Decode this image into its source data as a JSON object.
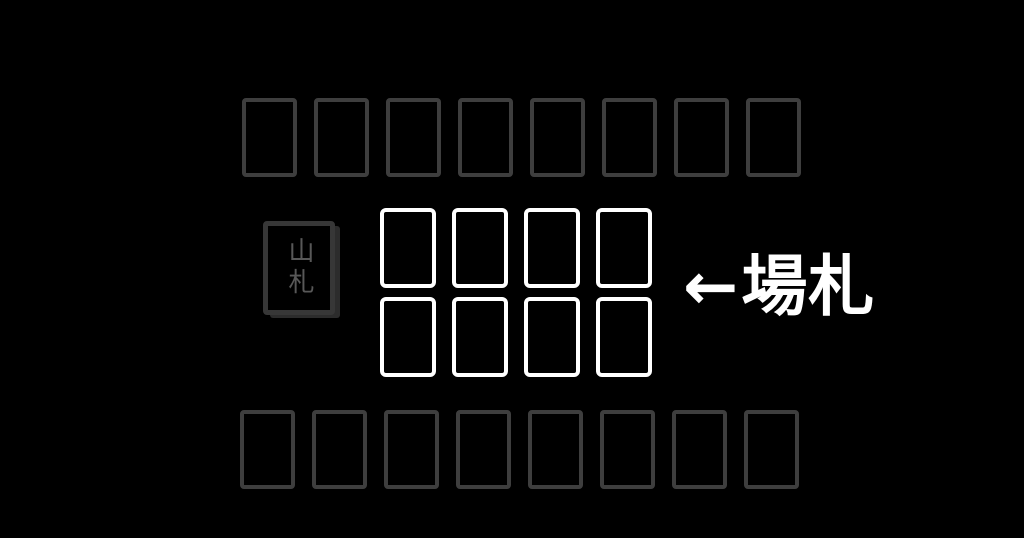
{
  "opponent_hand": {
    "card_count": 8
  },
  "deck": {
    "label": "山札"
  },
  "field": {
    "card_count": 8,
    "columns": 4,
    "rows": 2
  },
  "annotation": {
    "arrow": "←",
    "label": "場札"
  },
  "player_hand": {
    "card_count": 8
  },
  "colors": {
    "background": "#000000",
    "hand_card_border": "#3e3e3e",
    "deck_border": "#373737",
    "deck_stack_edge": "#2c2c2c",
    "deck_label_text": "#585858",
    "field_card_border": "#ffffff",
    "annotation_text": "#ffffff"
  }
}
